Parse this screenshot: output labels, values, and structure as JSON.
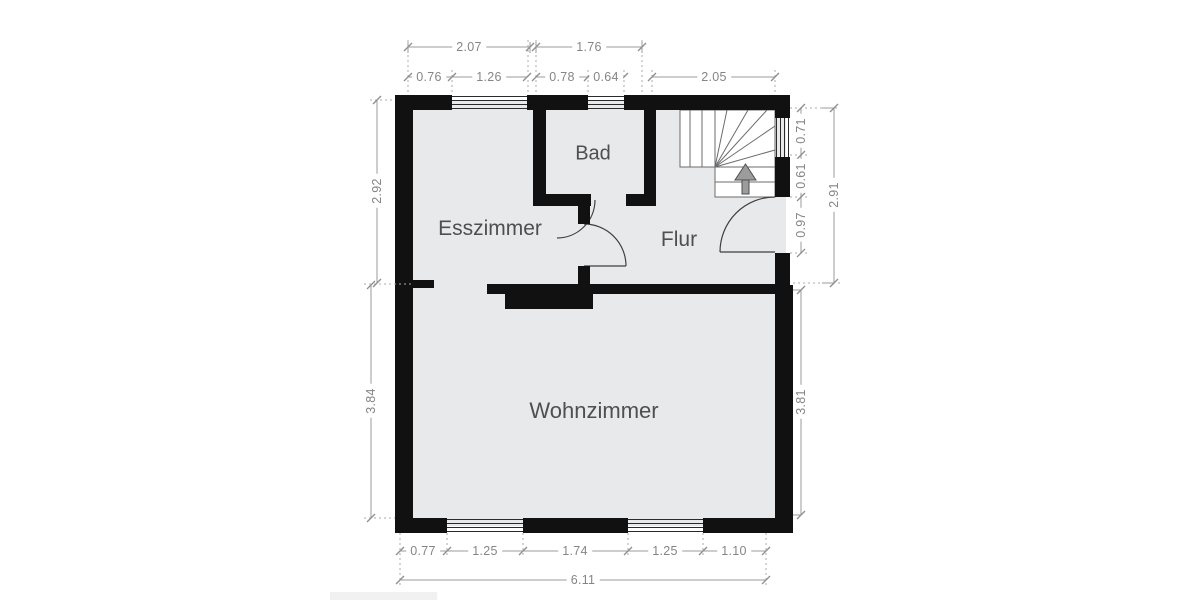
{
  "floor_plan": {
    "title": "Floor plan (ground floor)",
    "rooms": {
      "bad": "Bad",
      "esszimmer": "Esszimmer",
      "flur": "Flur",
      "wohnzimmer": "Wohnzimmer"
    },
    "dims": {
      "top_overall": [
        "2.07",
        "1.76"
      ],
      "top_detail": [
        "0.76",
        "1.26",
        "0.78",
        "0.64",
        "2.05"
      ],
      "left_upper": "2.92",
      "left_lower": "3.84",
      "right_detail": [
        "0.71",
        "0.61",
        "0.97"
      ],
      "right_overall": "2.91",
      "right_lower": "3.81",
      "bottom_detail": [
        "0.77",
        "1.25",
        "1.74",
        "1.25",
        "1.10"
      ],
      "bottom_overall": "6.11"
    },
    "colors": {
      "wall": "#111111",
      "room_fill": "#e8e9eb",
      "stair_fill": "#ffffff",
      "dim_line": "#9b9b9b",
      "dim_text": "#858585",
      "room_text": "#4f4f4f",
      "arrow_fill": "#9c9c9c"
    }
  }
}
